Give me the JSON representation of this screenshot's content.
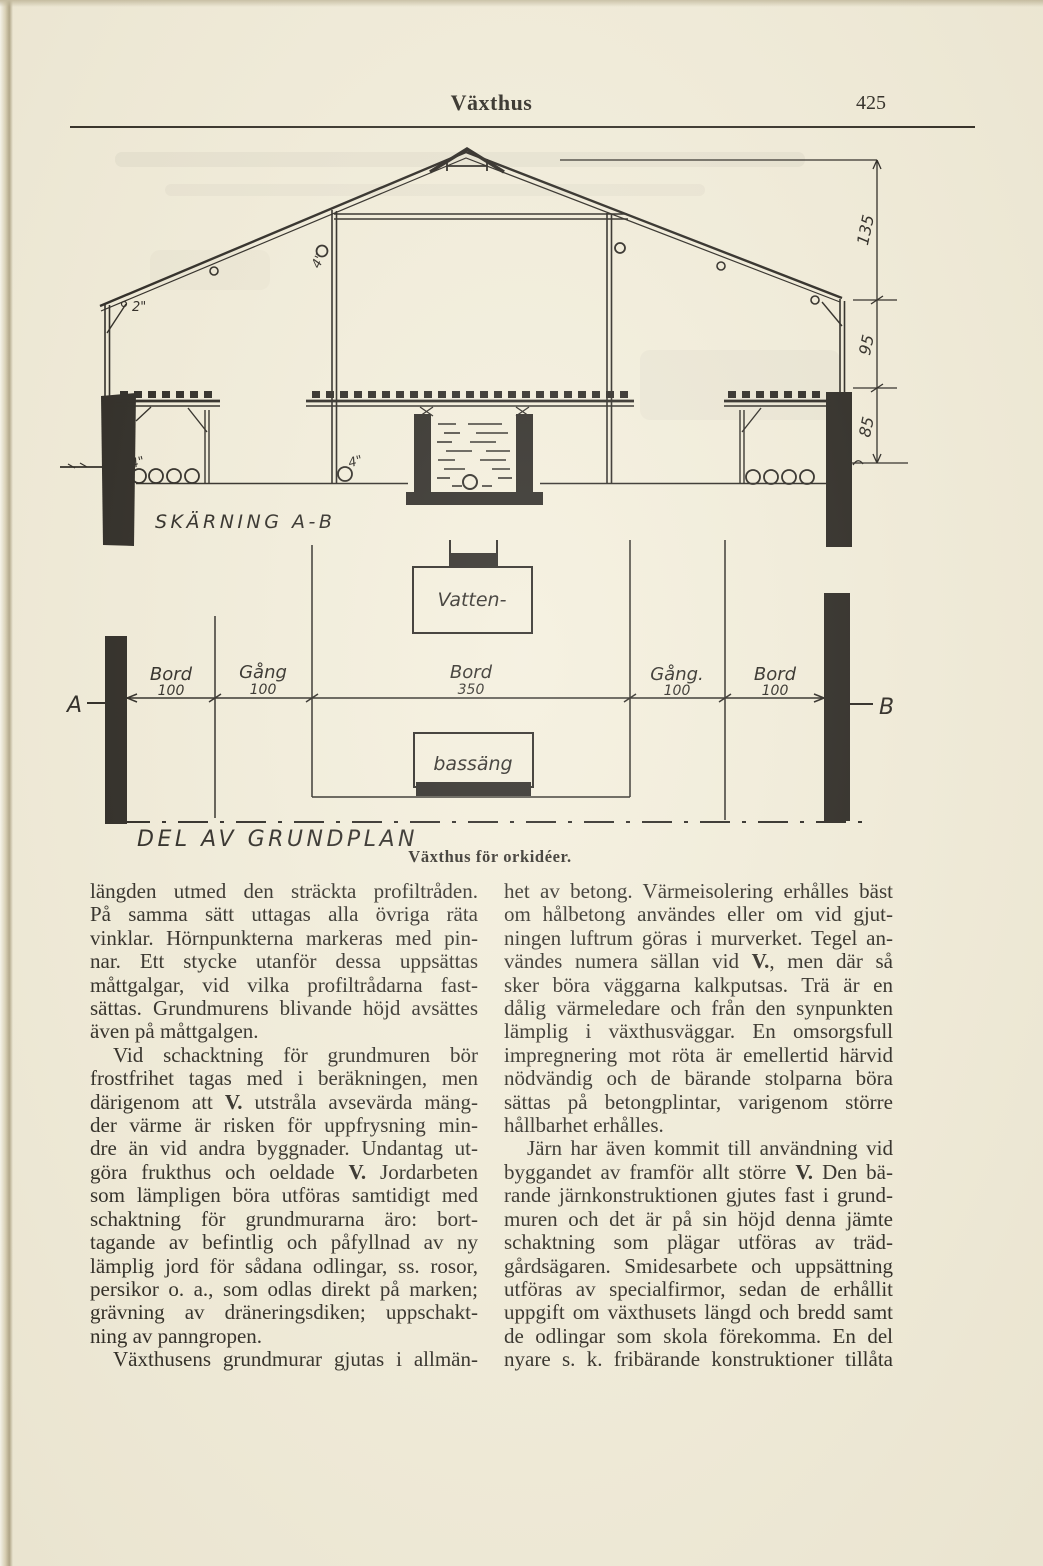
{
  "header": {
    "title": "Växthus",
    "page_number": "425"
  },
  "figure": {
    "caption": "Växthus för orkidéer.",
    "section": {
      "label": "SKÄRNING A-B",
      "dim_labels": [
        "135",
        "95",
        "85"
      ],
      "eave_label": "2\"",
      "ridge_vent_label": "4\"",
      "pipe_label_left": "4\"",
      "pipe_label_center": "4\""
    },
    "plan": {
      "label": "DEL AV GRUNDPLAN",
      "point_a": "A",
      "point_b": "B",
      "segments": [
        {
          "name": "Bord",
          "size": "100"
        },
        {
          "name": "Gång",
          "size": "100"
        },
        {
          "name": "Bord",
          "size": "350"
        },
        {
          "name": "Gång.",
          "size": "100"
        },
        {
          "name": "Bord",
          "size": "100"
        }
      ],
      "water_label": "Vatten-",
      "basin_label": "bassäng"
    }
  },
  "article": {
    "left_column": [
      {
        "t": "längden utmed den sträckta profiltråden."
      },
      {
        "t": "På samma sätt uttagas alla övriga räta"
      },
      {
        "t": "vinklar. Hörnpunkterna markeras med pin-"
      },
      {
        "t": "nar. Ett stycke utanför dessa uppsättas"
      },
      {
        "t": "måttgalgar, vid vilka profiltrådarna fast-"
      },
      {
        "t": "sättas. Grundmurens blivande höjd avsättes"
      },
      {
        "t": "även på måttgalgen.",
        "e": true
      },
      {
        "t": "Vid schacktning för grundmuren bör",
        "i": true
      },
      {
        "t": "frostfrihet tagas med i beräkningen, men"
      },
      {
        "t": "därigenom att **V.** utstråla avsevärda mäng-"
      },
      {
        "t": "der värme är risken för uppfrysning min-"
      },
      {
        "t": "dre än vid andra byggnader. Undantag ut-"
      },
      {
        "t": "göra frukthus och oeldade **V.** Jordarbeten"
      },
      {
        "t": "som lämpligen böra utföras samtidigt med"
      },
      {
        "t": "schaktning för grundmurarna äro: bort-"
      },
      {
        "t": "tagande av befintlig och påfyllnad av ny"
      },
      {
        "t": "lämplig jord för sådana odlingar, ss. rosor,"
      },
      {
        "t": "persikor o. a., som odlas direkt på marken;"
      },
      {
        "t": "grävning av dräneringsdiken; uppschakt-"
      },
      {
        "t": "ning av panngropen.",
        "e": true
      },
      {
        "t": "Växthusens grundmurar gjutas i allmän-",
        "i": true
      }
    ],
    "right_column": [
      {
        "t": "het av betong. Värmeisolering erhålles bäst"
      },
      {
        "t": "om hålbetong användes eller om vid gjut-"
      },
      {
        "t": "ningen luftrum göras i murverket. Tegel an-"
      },
      {
        "t": "vändes numera sällan vid **V.**, men där så"
      },
      {
        "t": "sker böra väggarna kalkputsas. Trä är en"
      },
      {
        "t": "dålig värmeledare och från den synpunkten"
      },
      {
        "t": "lämplig i växthusväggar. En omsorgsfull"
      },
      {
        "t": "impregnering mot röta är emellertid härvid"
      },
      {
        "t": "nödvändig och de bärande stolparna böra"
      },
      {
        "t": "sättas på betongplintar, varigenom större"
      },
      {
        "t": "hållbarhet erhålles.",
        "e": true
      },
      {
        "t": "Järn har även kommit till användning vid",
        "i": true
      },
      {
        "t": "byggandet av framför allt större **V.** Den bä-"
      },
      {
        "t": "rande järnkonstruktionen gjutes fast i grund-"
      },
      {
        "t": "muren och det är på sin höjd denna jämte"
      },
      {
        "t": "schaktning som plägar utföras av träd-"
      },
      {
        "t": "gårdsägaren. Smidesarbete och uppsättning"
      },
      {
        "t": "utföras av specialfirmor, sedan de erhållit"
      },
      {
        "t": "uppgift om växthusets längd och bredd samt"
      },
      {
        "t": "de odlingar som skola förekomma. En del"
      },
      {
        "t": "nyare s. k. fribärande konstruktioner tillåta"
      }
    ]
  }
}
